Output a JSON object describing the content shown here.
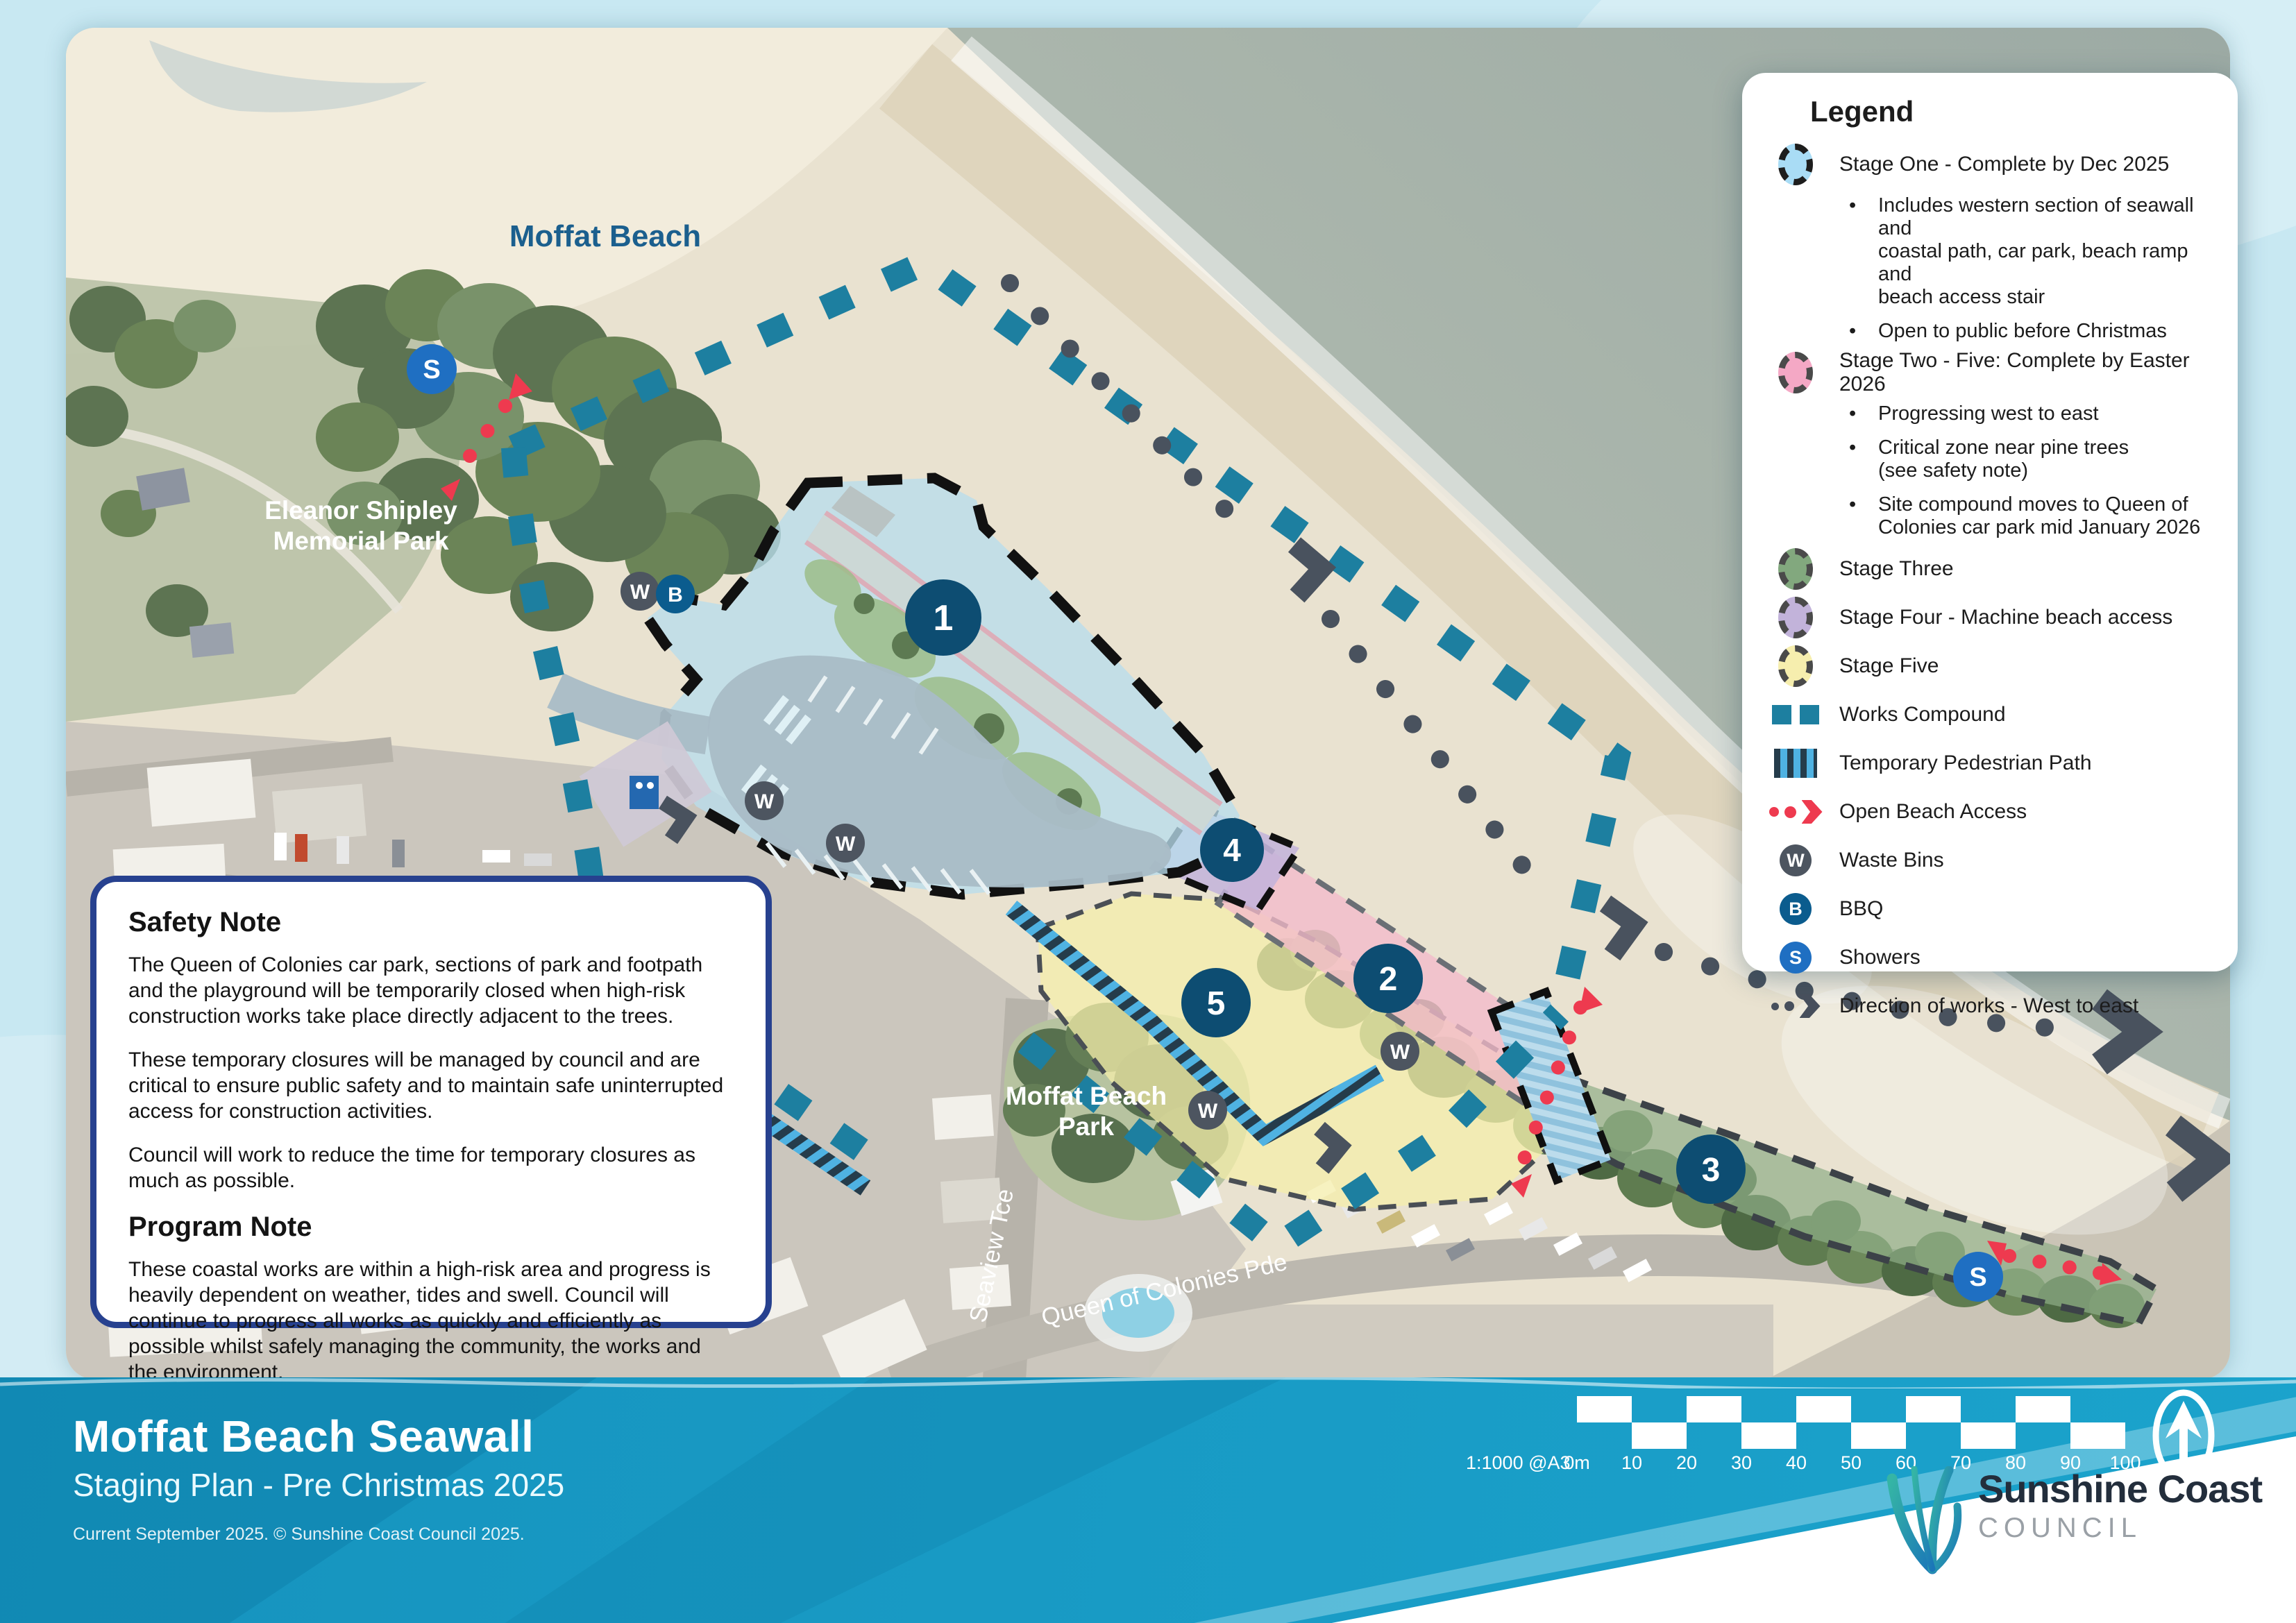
{
  "title_block": {
    "title": "Moffat Beach Seawall",
    "subtitle": "Staging Plan - Pre Christmas 2025",
    "credit": "Current September 2025. © Sunshine Coast Council 2025."
  },
  "legend": {
    "title": "Legend",
    "items": [
      {
        "icon": "stage-one-swatch",
        "label": "Stage One - Complete by Dec 2025"
      },
      {
        "lines": [
          "Includes western section of seawall and",
          "coastal path, car park, beach ramp and",
          "beach access stair"
        ]
      },
      {
        "lines": [
          "Open to public before Christmas"
        ]
      },
      {
        "icon": "stage-two-swatch",
        "label": "Stage Two  - Five: Complete by Easter 2026"
      },
      {
        "lines": [
          "Progressing west to east"
        ]
      },
      {
        "lines": [
          "Critical zone near pine trees",
          "(see safety note)"
        ]
      },
      {
        "lines": [
          "Site compound moves to Queen of",
          "Colonies car park mid January 2026"
        ]
      },
      {
        "icon": "stage-three-swatch",
        "label": "Stage Three"
      },
      {
        "icon": "stage-four-swatch",
        "label": "Stage Four - Machine beach access"
      },
      {
        "icon": "stage-five-swatch",
        "label": "Stage Five"
      },
      {
        "icon": "works-compound-swatch",
        "label": "Works Compound"
      },
      {
        "icon": "temporary-pedestrian-path-swatch",
        "label": "Temporary Pedestrian Path"
      },
      {
        "icon": "open-beach-access-swatch",
        "label": "Open Beach Access"
      },
      {
        "icon": "waste-bins-swatch",
        "label": "Waste Bins"
      },
      {
        "icon": "bbq-swatch",
        "label": "BBQ"
      },
      {
        "icon": "showers-swatch",
        "label": "Showers"
      },
      {
        "icon": "direction-of-works-swatch",
        "label": "Direction of works - West to east"
      }
    ]
  },
  "safety_note": {
    "heading": "Safety Note",
    "paragraphs": [
      "The Queen of Colonies car park, sections of park and footpath and the playground will be temporarily closed when high-risk construction works take place directly adjacent to the trees.",
      "These temporary closures will be managed by council and are critical to ensure public safety and to maintain safe uninterrupted access for construction activities.",
      "Council will work to reduce the time for temporary closures as much as possible."
    ],
    "program_heading": "Program Note",
    "program_paragraphs": [
      "These coastal works are within a high-risk area and progress is heavily dependent on weather, tides and swell.  Council will continue to progress all works as quickly and efficiently as possible whilst safely managing the community, the works and the environment."
    ]
  },
  "map": {
    "labels": {
      "beach": "Moffat Beach",
      "memorial_park_line1": "Eleanor Shipley",
      "memorial_park_line2": "Memorial Park",
      "beach_park_line1": "Moffat Beach",
      "beach_park_line2": "Park",
      "street_seaview": "Seaview Tce",
      "street_queen": "Queen of Colonies Pde",
      "street_bryce": "Bryce St"
    },
    "markers": {
      "stage_one": "1",
      "stage_two": "2",
      "stage_three": "3",
      "stage_four": "4",
      "stage_five": "5",
      "waste": "W",
      "bbq": "B",
      "shower": "S"
    }
  },
  "scale_bar": {
    "ratio_label": "1:1000 @A3",
    "ticks": [
      "0m",
      "10",
      "20",
      "30",
      "40",
      "50",
      "60",
      "70",
      "80",
      "90",
      "100"
    ]
  },
  "logo": {
    "name_line1": "Sunshine Coast",
    "name_line2": "COUNCIL"
  },
  "colors": {
    "stage_one": "#a9dcf5",
    "stage_two": "#f4a8c5",
    "stage_three": "#82a87e",
    "stage_four": "#c2b3da",
    "stage_five": "#f6eeae",
    "works_compound": "#1d7fa0",
    "open_beach_access": "#ee3a4f",
    "waste_bins": "#4d5560",
    "bbq": "#0b5c8e",
    "showers": "#1f6fc2",
    "direction_of_works": "#474f5c",
    "footer_band": "#1693be"
  }
}
